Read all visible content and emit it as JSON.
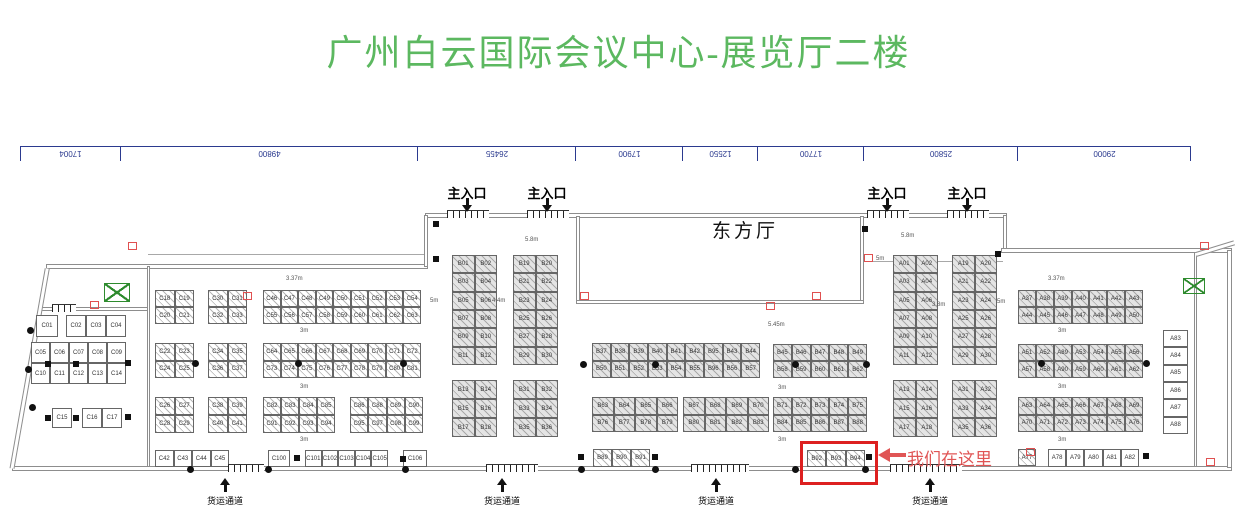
{
  "title": {
    "text": "广州白云国际会议中心-展览厅二楼",
    "color": "#5cb860"
  },
  "ruler": {
    "x": 20,
    "y": 146,
    "color": "#2b3a8f",
    "segments": [
      {
        "label": "17004",
        "width": 101
      },
      {
        "label": "49800",
        "width": 297
      },
      {
        "label": "26455",
        "width": 158
      },
      {
        "label": "17900",
        "width": 107
      },
      {
        "label": "12550",
        "width": 75
      },
      {
        "label": "17700",
        "width": 106
      },
      {
        "label": "25800",
        "width": 154
      },
      {
        "label": "29000",
        "width": 173
      }
    ]
  },
  "hall_label": {
    "text": "东方厅"
  },
  "entrances": {
    "label": "主入口",
    "positions": [
      467,
      547,
      887,
      967
    ],
    "label_y": 183,
    "arrow_y": 198
  },
  "freight": {
    "label": "货运通道",
    "positions": [
      225,
      502,
      716,
      930
    ],
    "label_y": 494,
    "arrow_y": 478
  },
  "highlight": {
    "label": "我们在这里",
    "color": "#e05555",
    "box_color": "#dd2020",
    "box": {
      "x": 800,
      "y": 441,
      "w": 72,
      "h": 38
    },
    "arrow": {
      "x1": 878,
      "x2": 904,
      "y": 455
    },
    "label_x": 907,
    "label_y": 445
  },
  "dims": [
    {
      "x": 286,
      "y": 276,
      "t": "3.37m"
    },
    {
      "x": 300,
      "y": 328,
      "t": "3m"
    },
    {
      "x": 300,
      "y": 384,
      "t": "3m"
    },
    {
      "x": 300,
      "y": 437,
      "t": "3m"
    },
    {
      "x": 430,
      "y": 298,
      "t": "5m"
    },
    {
      "x": 492,
      "y": 298,
      "t": "4.4m"
    },
    {
      "x": 525,
      "y": 237,
      "t": "5.8m"
    },
    {
      "x": 901,
      "y": 233,
      "t": "5.8m"
    },
    {
      "x": 876,
      "y": 256,
      "t": "5m"
    },
    {
      "x": 768,
      "y": 322,
      "t": "5.45m"
    },
    {
      "x": 932,
      "y": 302,
      "t": "3.8m"
    },
    {
      "x": 997,
      "y": 299,
      "t": "5m"
    },
    {
      "x": 778,
      "y": 385,
      "t": "3m"
    },
    {
      "x": 778,
      "y": 437,
      "t": "3m"
    },
    {
      "x": 1048,
      "y": 276,
      "t": "3.37m"
    },
    {
      "x": 1058,
      "y": 328,
      "t": "3m"
    },
    {
      "x": 1058,
      "y": 384,
      "t": "3m"
    },
    {
      "x": 1058,
      "y": 437,
      "t": "3m"
    }
  ],
  "walls": [
    {
      "x": 12,
      "y": 466,
      "w": 1220,
      "h": 5
    },
    {
      "x": 46,
      "y": 264,
      "w": 382,
      "h": 5
    },
    {
      "x": 425,
      "y": 213,
      "w": 582,
      "h": 5
    },
    {
      "x": 424,
      "y": 215,
      "w": 4,
      "h": 52
    },
    {
      "x": 1003,
      "y": 215,
      "w": 4,
      "h": 38
    },
    {
      "x": 1001,
      "y": 248,
      "w": 231,
      "h": 5
    },
    {
      "x": 1227,
      "y": 250,
      "w": 5,
      "h": 218
    },
    {
      "x": 576,
      "y": 216,
      "w": 4,
      "h": 88
    },
    {
      "x": 860,
      "y": 216,
      "w": 4,
      "h": 88
    },
    {
      "x": 576,
      "y": 300,
      "w": 288,
      "h": 4
    },
    {
      "x": 38,
      "y": 307,
      "w": 112,
      "h": 4
    },
    {
      "x": 147,
      "y": 266,
      "w": 3,
      "h": 201
    },
    {
      "x": 1194,
      "y": 252,
      "w": 3,
      "h": 215
    }
  ],
  "slants": [
    {
      "x": 12,
      "y": 466,
      "len": 203,
      "deg": -80
    },
    {
      "x": 1196,
      "y": 252,
      "len": 40,
      "deg": -17
    }
  ],
  "thin_lines": [
    {
      "x": 148,
      "y": 254,
      "w": 280,
      "h": 1
    },
    {
      "x": 864,
      "y": 261,
      "w": 139,
      "h": 1
    }
  ],
  "doors": [
    {
      "x": 447,
      "y": 210,
      "w": 42
    },
    {
      "x": 527,
      "y": 210,
      "w": 42
    },
    {
      "x": 867,
      "y": 210,
      "w": 42
    },
    {
      "x": 947,
      "y": 210,
      "w": 42
    },
    {
      "x": 228,
      "y": 464,
      "w": 36
    },
    {
      "x": 486,
      "y": 464,
      "w": 52
    },
    {
      "x": 691,
      "y": 464,
      "w": 58
    },
    {
      "x": 890,
      "y": 464,
      "w": 72
    },
    {
      "x": 52,
      "y": 304,
      "w": 24
    }
  ],
  "columns": [
    {
      "x": 192,
      "y": 360
    },
    {
      "x": 295,
      "y": 360
    },
    {
      "x": 400,
      "y": 360
    },
    {
      "x": 580,
      "y": 361
    },
    {
      "x": 652,
      "y": 361
    },
    {
      "x": 792,
      "y": 361
    },
    {
      "x": 863,
      "y": 361
    },
    {
      "x": 1038,
      "y": 360
    },
    {
      "x": 1143,
      "y": 360
    },
    {
      "x": 27,
      "y": 327
    },
    {
      "x": 25,
      "y": 366
    },
    {
      "x": 29,
      "y": 404
    },
    {
      "x": 187,
      "y": 466
    },
    {
      "x": 265,
      "y": 466
    },
    {
      "x": 402,
      "y": 466
    },
    {
      "x": 578,
      "y": 466
    },
    {
      "x": 652,
      "y": 466
    },
    {
      "x": 792,
      "y": 466
    },
    {
      "x": 862,
      "y": 466
    }
  ],
  "pillars": [
    {
      "x": 45,
      "y": 361
    },
    {
      "x": 73,
      "y": 361
    },
    {
      "x": 125,
      "y": 360
    },
    {
      "x": 45,
      "y": 415
    },
    {
      "x": 73,
      "y": 415
    },
    {
      "x": 125,
      "y": 414
    },
    {
      "x": 433,
      "y": 221
    },
    {
      "x": 433,
      "y": 256
    },
    {
      "x": 862,
      "y": 226
    },
    {
      "x": 995,
      "y": 251
    },
    {
      "x": 294,
      "y": 455
    },
    {
      "x": 400,
      "y": 456
    },
    {
      "x": 578,
      "y": 454
    },
    {
      "x": 652,
      "y": 454
    },
    {
      "x": 866,
      "y": 454
    },
    {
      "x": 1143,
      "y": 453
    }
  ],
  "red_marks": [
    {
      "x": 90,
      "y": 301
    },
    {
      "x": 243,
      "y": 292
    },
    {
      "x": 580,
      "y": 292
    },
    {
      "x": 812,
      "y": 292
    },
    {
      "x": 766,
      "y": 302
    },
    {
      "x": 864,
      "y": 254
    },
    {
      "x": 1026,
      "y": 448
    },
    {
      "x": 1206,
      "y": 458
    },
    {
      "x": 128,
      "y": 242
    },
    {
      "x": 1200,
      "y": 242
    }
  ],
  "escalators": [
    {
      "x": 104,
      "y": 283,
      "w": 24,
      "h": 17
    },
    {
      "x": 1183,
      "y": 278,
      "w": 20,
      "h": 14
    }
  ],
  "booth_blocks": [
    {
      "id": "c01",
      "x": 36,
      "y": 315,
      "w": 22,
      "h": 22,
      "cols": 1,
      "rows": 1,
      "style": "p",
      "labels": [
        "C01"
      ]
    },
    {
      "id": "c02-c04",
      "x": 66,
      "y": 315,
      "w": 60,
      "h": 22,
      "cols": 3,
      "rows": 1,
      "style": "p",
      "labels": [
        "C02",
        "C03",
        "C04"
      ]
    },
    {
      "id": "c05-c14",
      "x": 31,
      "y": 342,
      "w": 95,
      "h": 42,
      "cols": 5,
      "rows": 2,
      "style": "p",
      "labels": [
        "C05",
        "C06",
        "C07",
        "C08",
        "C09",
        "C10",
        "C11",
        "C12",
        "C13",
        "C14"
      ]
    },
    {
      "id": "c15",
      "x": 52,
      "y": 408,
      "w": 20,
      "h": 20,
      "cols": 1,
      "rows": 1,
      "style": "p",
      "labels": [
        "C15"
      ]
    },
    {
      "id": "c16-c17",
      "x": 82,
      "y": 408,
      "w": 40,
      "h": 20,
      "cols": 2,
      "rows": 1,
      "style": "p",
      "labels": [
        "C16",
        "C17"
      ]
    },
    {
      "id": "c18-c21",
      "x": 155,
      "y": 290,
      "w": 39,
      "h": 34,
      "cols": 2,
      "rows": 2,
      "style": "hw",
      "labels": [
        "C18",
        "C19",
        "C20",
        "C21"
      ]
    },
    {
      "id": "c30-c33",
      "x": 208,
      "y": 290,
      "w": 39,
      "h": 34,
      "cols": 2,
      "rows": 2,
      "style": "hw",
      "labels": [
        "C30",
        "C31",
        "C32",
        "C33"
      ]
    },
    {
      "id": "c46-c63",
      "x": 263,
      "y": 290,
      "w": 158,
      "h": 34,
      "cols": 9,
      "rows": 2,
      "style": "hw",
      "labels": [
        "C46",
        "C47",
        "C48",
        "C49",
        "C50",
        "C51",
        "C52",
        "C53",
        "C54",
        "C55",
        "C56",
        "C57",
        "C58",
        "C59",
        "C60",
        "C61",
        "C62",
        "C63"
      ]
    },
    {
      "id": "c22-c25",
      "x": 155,
      "y": 343,
      "w": 39,
      "h": 35,
      "cols": 2,
      "rows": 2,
      "style": "hw",
      "labels": [
        "C22",
        "C23",
        "C24",
        "C25"
      ]
    },
    {
      "id": "c34-c37",
      "x": 208,
      "y": 343,
      "w": 39,
      "h": 35,
      "cols": 2,
      "rows": 2,
      "style": "hw",
      "labels": [
        "C34",
        "C35",
        "C36",
        "C37"
      ]
    },
    {
      "id": "c64-c81",
      "x": 263,
      "y": 343,
      "w": 158,
      "h": 35,
      "cols": 9,
      "rows": 2,
      "style": "hw",
      "labels": [
        "C64",
        "C65",
        "C66",
        "C67",
        "C68",
        "C69",
        "C70",
        "C71",
        "C72",
        "C73",
        "C74",
        "C75",
        "C76",
        "C77",
        "C78",
        "C79",
        "C80",
        "C81"
      ]
    },
    {
      "id": "c26-c29",
      "x": 155,
      "y": 397,
      "w": 39,
      "h": 36,
      "cols": 2,
      "rows": 2,
      "style": "hw",
      "labels": [
        "C26",
        "C27",
        "C28",
        "C29"
      ]
    },
    {
      "id": "c38-c41",
      "x": 208,
      "y": 397,
      "w": 39,
      "h": 36,
      "cols": 2,
      "rows": 2,
      "style": "hw",
      "labels": [
        "C38",
        "C39",
        "C40",
        "C41"
      ]
    },
    {
      "id": "c82-c94",
      "x": 263,
      "y": 397,
      "w": 72,
      "h": 36,
      "cols": 4,
      "rows": 2,
      "style": "hw",
      "labels": [
        "C82",
        "C83",
        "C84",
        "C85",
        "C91",
        "C92",
        "C93",
        "C94"
      ]
    },
    {
      "id": "c86-c99",
      "x": 350,
      "y": 397,
      "w": 73,
      "h": 36,
      "cols": 4,
      "rows": 2,
      "style": "hw",
      "labels": [
        "C86",
        "C88",
        "C89",
        "C90",
        "C95",
        "C97",
        "C98",
        "C99"
      ]
    },
    {
      "id": "c42-c45",
      "x": 155,
      "y": 450,
      "w": 74,
      "h": 17,
      "cols": 4,
      "rows": 1,
      "style": "p",
      "labels": [
        "C42",
        "C43",
        "C44",
        "C45"
      ]
    },
    {
      "id": "c100",
      "x": 268,
      "y": 450,
      "w": 22,
      "h": 17,
      "cols": 1,
      "rows": 1,
      "style": "p",
      "labels": [
        "C100"
      ]
    },
    {
      "id": "c101-c105",
      "x": 305,
      "y": 450,
      "w": 83,
      "h": 17,
      "cols": 5,
      "rows": 1,
      "style": "p",
      "labels": [
        "C101",
        "C102",
        "C103",
        "C104",
        "C105"
      ]
    },
    {
      "id": "c106",
      "x": 403,
      "y": 450,
      "w": 24,
      "h": 17,
      "cols": 1,
      "rows": 1,
      "style": "p",
      "labels": [
        "C106"
      ]
    },
    {
      "id": "b01-b12",
      "x": 452,
      "y": 255,
      "w": 45,
      "h": 110,
      "cols": 2,
      "rows": 6,
      "style": "hg",
      "labels": [
        "B01",
        "B02",
        "B03",
        "B04",
        "B05",
        "B06",
        "B07",
        "B08",
        "B09",
        "B10",
        "B11",
        "B12"
      ]
    },
    {
      "id": "b19-b30",
      "x": 513,
      "y": 255,
      "w": 45,
      "h": 110,
      "cols": 2,
      "rows": 6,
      "style": "hg",
      "labels": [
        "B19",
        "B20",
        "B21",
        "B22",
        "B23",
        "B24",
        "B25",
        "B26",
        "B27",
        "B28",
        "B29",
        "B30"
      ]
    },
    {
      "id": "b13-b18",
      "x": 452,
      "y": 380,
      "w": 45,
      "h": 57,
      "cols": 2,
      "rows": 3,
      "style": "hg",
      "labels": [
        "B13",
        "B14",
        "B15",
        "B16",
        "B17",
        "B18"
      ]
    },
    {
      "id": "b31-b36",
      "x": 513,
      "y": 380,
      "w": 45,
      "h": 57,
      "cols": 2,
      "rows": 3,
      "style": "hg",
      "labels": [
        "B31",
        "B32",
        "B33",
        "B34",
        "B35",
        "B36"
      ]
    },
    {
      "id": "b37-b57",
      "x": 592,
      "y": 343,
      "w": 168,
      "h": 35,
      "cols": 9,
      "rows": 2,
      "style": "hg",
      "labels": [
        "B37",
        "B38",
        "B39",
        "B40",
        "B41",
        "B42",
        "B95",
        "B43",
        "B44",
        "B50",
        "B51",
        "B52",
        "B53",
        "B54",
        "B55",
        "B96",
        "B56",
        "B57"
      ]
    },
    {
      "id": "b45-b62",
      "x": 773,
      "y": 344,
      "w": 94,
      "h": 34,
      "cols": 5,
      "rows": 2,
      "style": "hg",
      "labels": [
        "B45",
        "B46",
        "B47",
        "B48",
        "B49",
        "B58",
        "B59",
        "B60",
        "B61",
        "B62"
      ]
    },
    {
      "id": "b63-b79",
      "x": 592,
      "y": 397,
      "w": 86,
      "h": 35,
      "cols": 4,
      "rows": 2,
      "style": "hg",
      "labels": [
        "B63",
        "B64",
        "B65",
        "B66",
        "B76",
        "B77",
        "B78",
        "B79"
      ]
    },
    {
      "id": "b67-b83",
      "x": 683,
      "y": 397,
      "w": 86,
      "h": 35,
      "cols": 4,
      "rows": 2,
      "style": "hg",
      "labels": [
        "B67",
        "B68",
        "B69",
        "B70",
        "B80",
        "B81",
        "B82",
        "B83"
      ]
    },
    {
      "id": "b71-b88",
      "x": 773,
      "y": 397,
      "w": 94,
      "h": 35,
      "cols": 5,
      "rows": 2,
      "style": "hg",
      "labels": [
        "B71",
        "B72",
        "B73",
        "B74",
        "B75",
        "B84",
        "B85",
        "B86",
        "B87",
        "B88"
      ]
    },
    {
      "id": "b89-b91",
      "x": 593,
      "y": 449,
      "w": 57,
      "h": 18,
      "cols": 3,
      "rows": 1,
      "style": "hw",
      "labels": [
        "B89",
        "B90",
        "B91"
      ]
    },
    {
      "id": "b92-b94",
      "x": 807,
      "y": 450,
      "w": 58,
      "h": 17,
      "cols": 3,
      "rows": 1,
      "style": "hw",
      "labels": [
        "B92",
        "B93",
        "B94"
      ]
    },
    {
      "id": "a01-a12",
      "x": 893,
      "y": 255,
      "w": 45,
      "h": 110,
      "cols": 2,
      "rows": 6,
      "style": "hg",
      "labels": [
        "A01",
        "A02",
        "A03",
        "A04",
        "A05",
        "A06",
        "A07",
        "A08",
        "A09",
        "A10",
        "A11",
        "A12"
      ]
    },
    {
      "id": "a19-a30",
      "x": 952,
      "y": 255,
      "w": 45,
      "h": 110,
      "cols": 2,
      "rows": 6,
      "style": "hg",
      "labels": [
        "A19",
        "A20",
        "A21",
        "A22",
        "A23",
        "A24",
        "A25",
        "A26",
        "A27",
        "A28",
        "A29",
        "A30"
      ]
    },
    {
      "id": "a13-a18",
      "x": 893,
      "y": 380,
      "w": 45,
      "h": 57,
      "cols": 2,
      "rows": 3,
      "style": "hg",
      "labels": [
        "A13",
        "A14",
        "A15",
        "A16",
        "A17",
        "A18"
      ]
    },
    {
      "id": "a31-a36",
      "x": 952,
      "y": 380,
      "w": 45,
      "h": 57,
      "cols": 2,
      "rows": 3,
      "style": "hg",
      "labels": [
        "A31",
        "A32",
        "A33",
        "A34",
        "A35",
        "A36"
      ]
    },
    {
      "id": "a37-a50",
      "x": 1018,
      "y": 290,
      "w": 125,
      "h": 34,
      "cols": 7,
      "rows": 2,
      "style": "hg",
      "labels": [
        "A37",
        "A38",
        "A39",
        "A40",
        "A41",
        "A42",
        "A43",
        "A44",
        "A45",
        "A46",
        "A47",
        "A48",
        "A49",
        "A50"
      ]
    },
    {
      "id": "a51-a62",
      "x": 1018,
      "y": 344,
      "w": 125,
      "h": 34,
      "cols": 7,
      "rows": 2,
      "style": "hg",
      "labels": [
        "A51",
        "A52",
        "A89",
        "A53",
        "A54",
        "A55",
        "A56",
        "A57",
        "A58",
        "A90",
        "A59",
        "A60",
        "A61",
        "A62"
      ]
    },
    {
      "id": "a63-a76",
      "x": 1018,
      "y": 397,
      "w": 125,
      "h": 35,
      "cols": 7,
      "rows": 2,
      "style": "hg",
      "labels": [
        "A63",
        "A64",
        "A65",
        "A66",
        "A67",
        "A68",
        "A69",
        "A70",
        "A71",
        "A72",
        "A73",
        "A74",
        "A75",
        "A76"
      ]
    },
    {
      "id": "a77",
      "x": 1018,
      "y": 449,
      "w": 18,
      "h": 17,
      "cols": 1,
      "rows": 1,
      "style": "hw",
      "labels": [
        "A77"
      ]
    },
    {
      "id": "a78-a82",
      "x": 1048,
      "y": 449,
      "w": 91,
      "h": 18,
      "cols": 5,
      "rows": 1,
      "style": "p",
      "labels": [
        "A78",
        "A79",
        "A80",
        "A81",
        "A82"
      ]
    },
    {
      "id": "a83-a88",
      "x": 1163,
      "y": 330,
      "w": 25,
      "h": 104,
      "cols": 1,
      "rows": 6,
      "style": "p",
      "labels": [
        "A83",
        "A84",
        "A85",
        "A86",
        "A87",
        "A88"
      ]
    }
  ]
}
